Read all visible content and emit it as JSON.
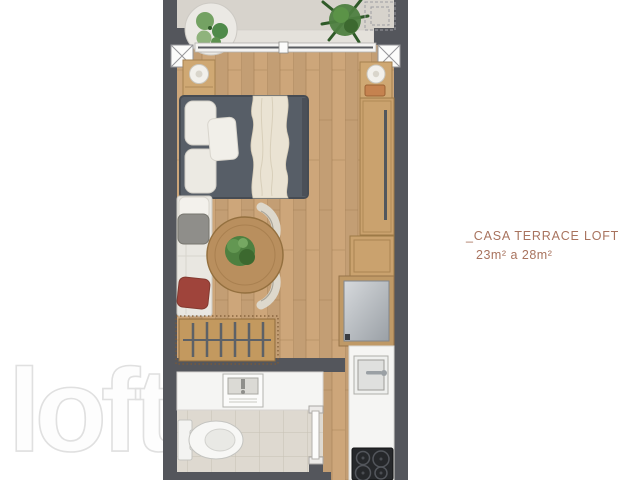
{
  "page": {
    "width": 640,
    "height": 480,
    "background": "#ffffff"
  },
  "plan_label": {
    "title": "_CASA TERRACE LOFT",
    "area_range": "23m² a 28m²"
  },
  "watermark": {
    "text": "loft"
  },
  "palette": {
    "wall": "#54565c",
    "wood_floor": "#cda67a",
    "terrace_floor": "#d7d3cc",
    "tile_floor": "#ded9d0",
    "bed_duvet": "#575e67",
    "sofa": "#e9e7e1",
    "pillow_red": "#9f443b",
    "pillow_gray": "#8f8e8a",
    "table_wood": "#b98f5e",
    "plant_green": "#4e8040",
    "cabinet_wood": "#caa26e",
    "counter_white": "#f5f5f3",
    "cooktop_black": "#26282b",
    "watermark_gray": "#e0e0e0",
    "label_terracotta": "#a8735e"
  }
}
